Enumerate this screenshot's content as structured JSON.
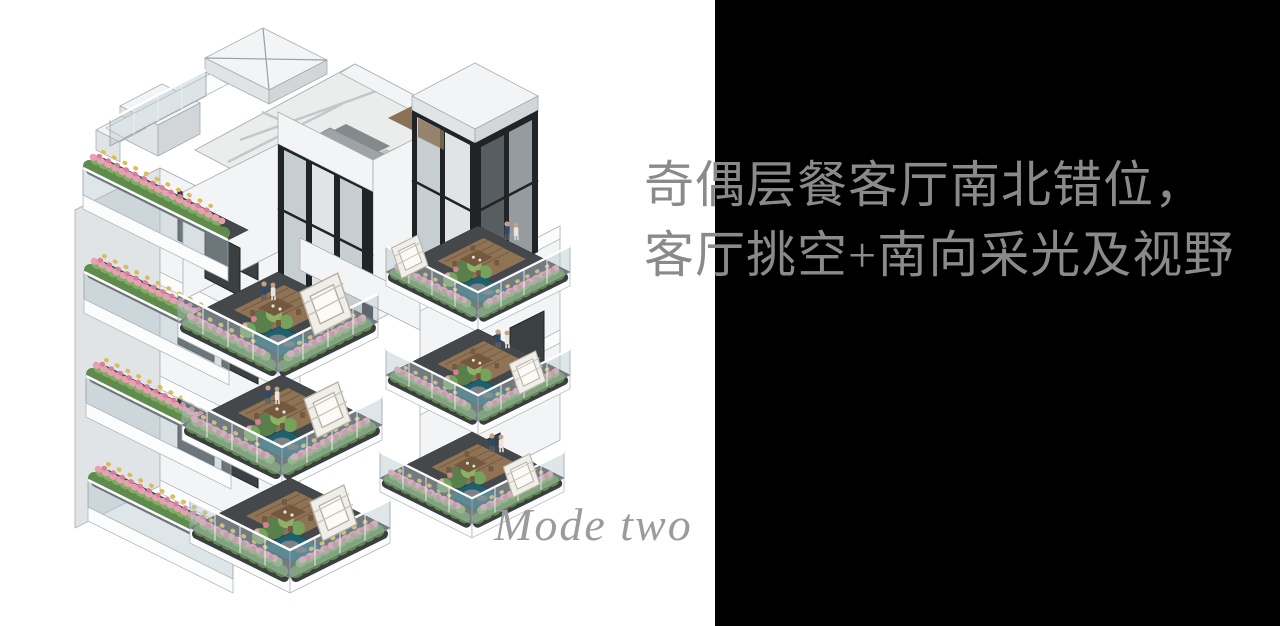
{
  "page": {
    "width": 1280,
    "height": 626,
    "background": "#ffffff"
  },
  "right_panel": {
    "background": "#000000"
  },
  "caption": {
    "line1": "奇偶层餐客厅南北错位，",
    "line2": "客厅挑空+南向采光及视野",
    "color": "#8a8a8a"
  },
  "mode_label": {
    "text": "Mode two",
    "color": "#9b9b9b"
  },
  "illustration": {
    "name": "residential-building-axonometric-render",
    "palette": {
      "wall_white": "#f3f4f5",
      "wall_shade": "#e1e4e6",
      "terrace_floor": "#45484b",
      "wood_deck": "#8f7354",
      "foliage_green": "#5f8b4c",
      "flower_pink": "#e79fb4",
      "flower_yellow": "#d9bd55",
      "pond_teal": "#1f5f6e",
      "window_glass": "#3b4043",
      "frame_black": "#202427"
    }
  }
}
